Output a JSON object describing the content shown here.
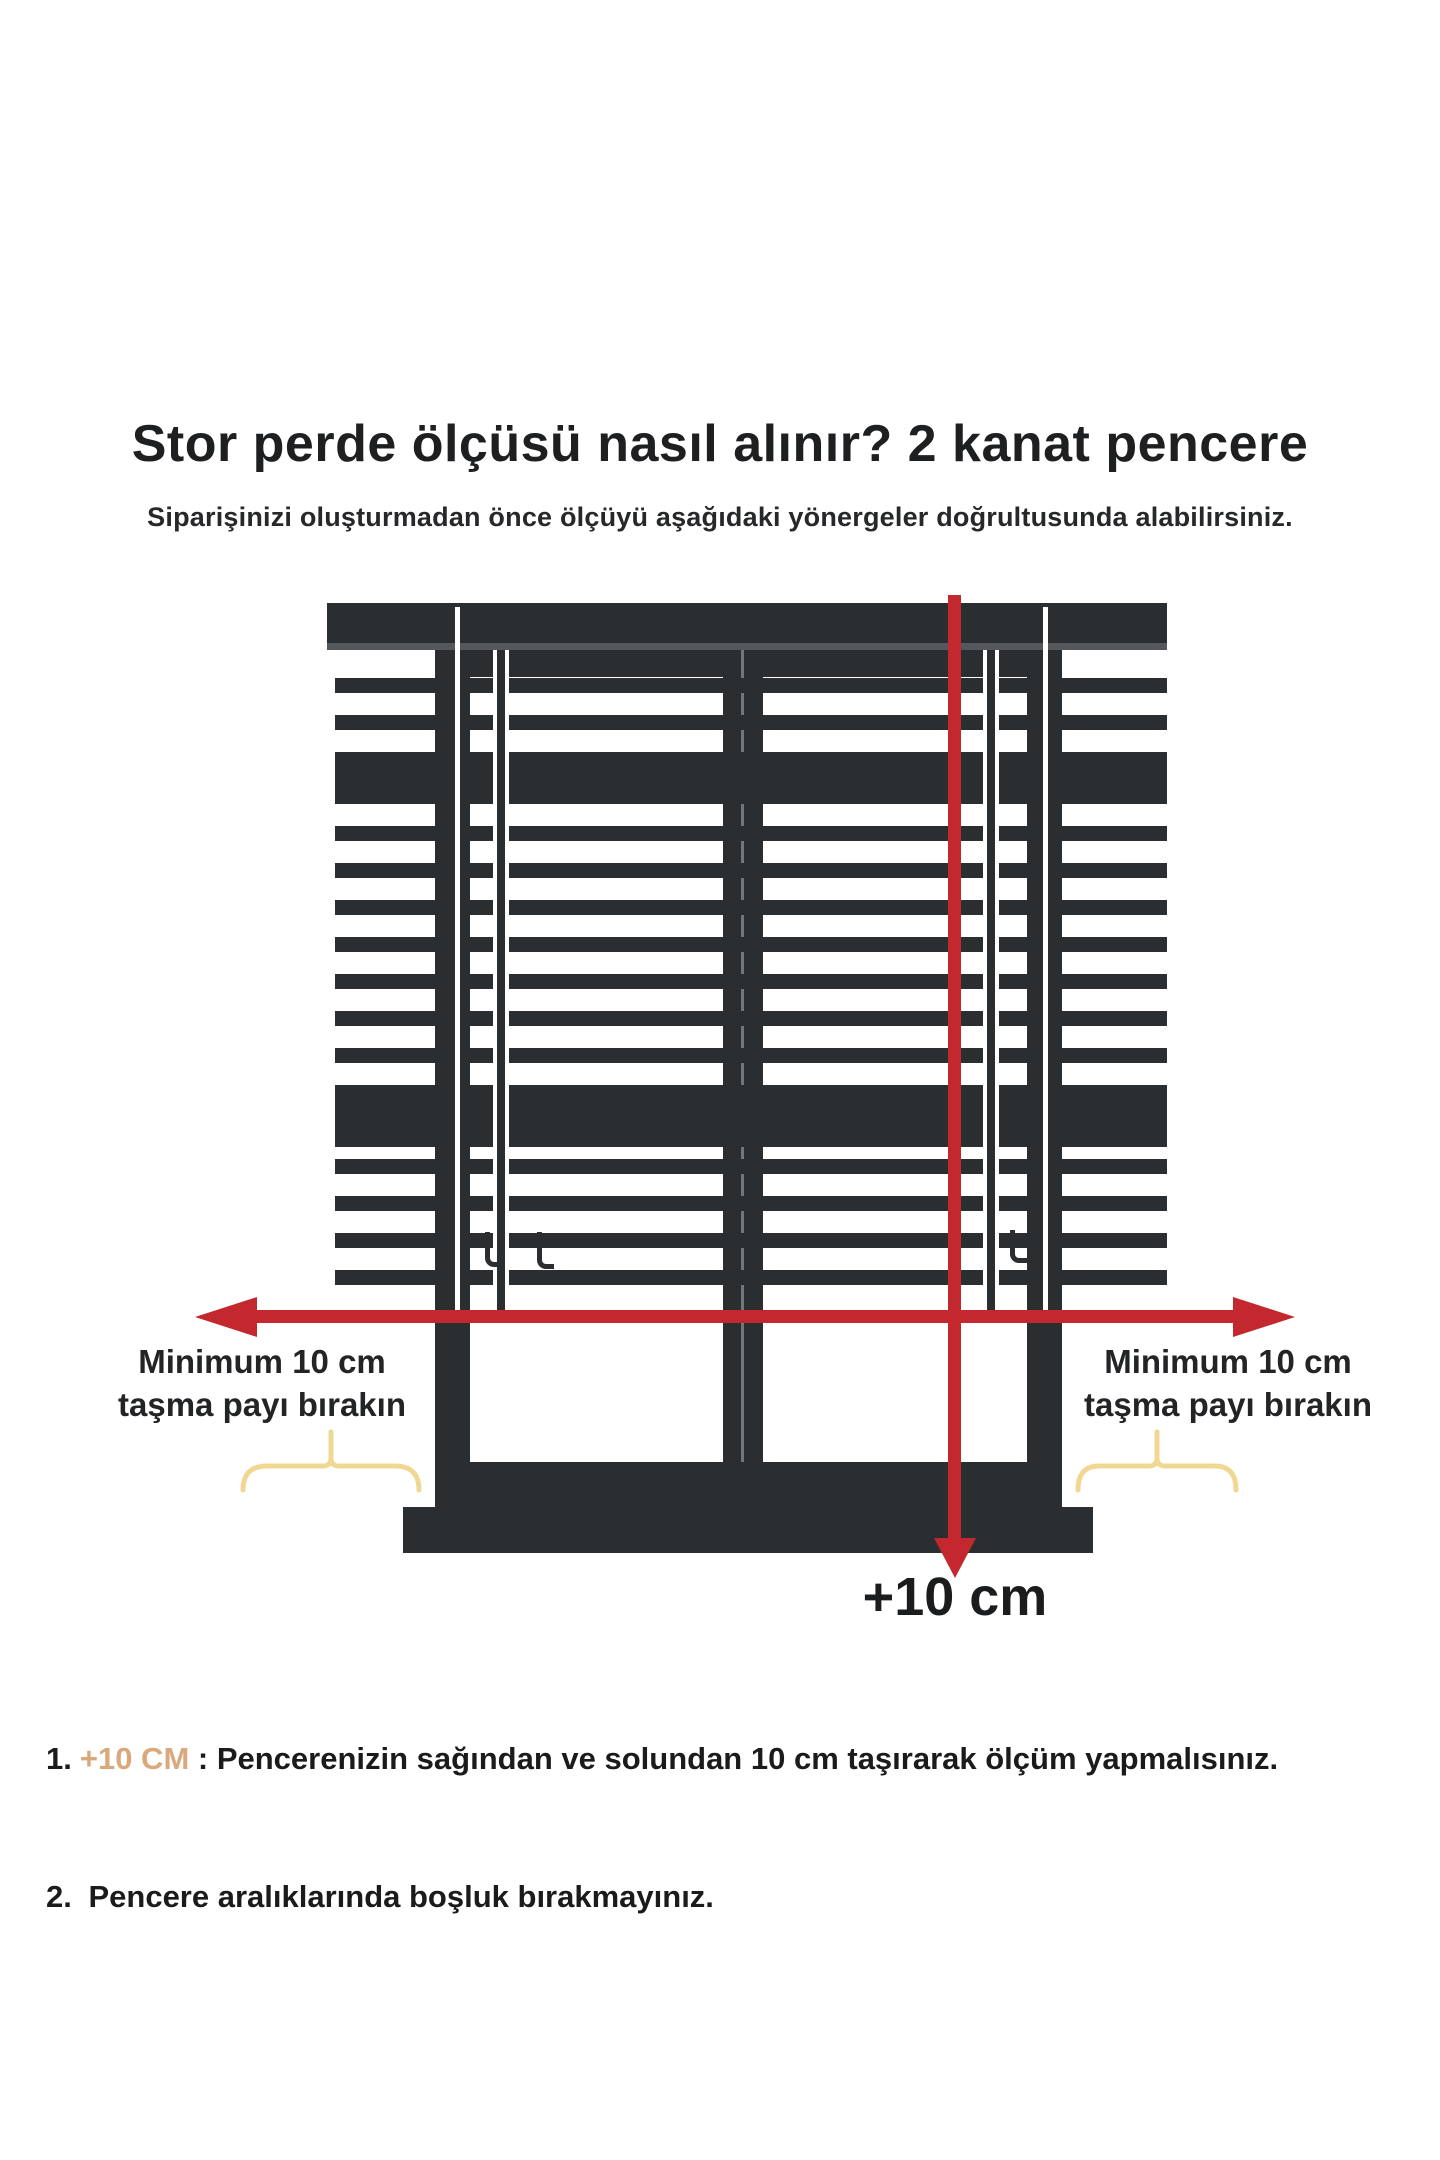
{
  "header": {
    "title": "Stor perde ölçüsü nasıl alınır? 2 kanat pencere",
    "subtitle": "Siparişinizi oluşturmadan önce ölçüyü aşağıdaki yönergeler doğrultusunda alabilirsiniz."
  },
  "diagram": {
    "left_overhang_label": {
      "line1": "Minimum 10 cm",
      "line2": "taşma payı bırakın"
    },
    "right_overhang_label": {
      "line1": "Minimum 10 cm",
      "line2": "taşma payı bırakın"
    },
    "bottom_measure_label": "+10 cm",
    "colors": {
      "measure_arrow_red": "#c2282e",
      "frame_dark": "#2b2e31",
      "brace_yellow": "#f0d893",
      "highlight_tan": "#d9a87b"
    }
  },
  "instructions": {
    "item1": {
      "number": "1.",
      "highlight": "+10 CM",
      "rest": " : Pencerenizin sağından ve solundan 10 cm taşırarak ölçüm yapmalısınız."
    },
    "item2": {
      "number": "2.",
      "rest": " Pencere aralıklarında boşluk bırakmayınız."
    }
  }
}
